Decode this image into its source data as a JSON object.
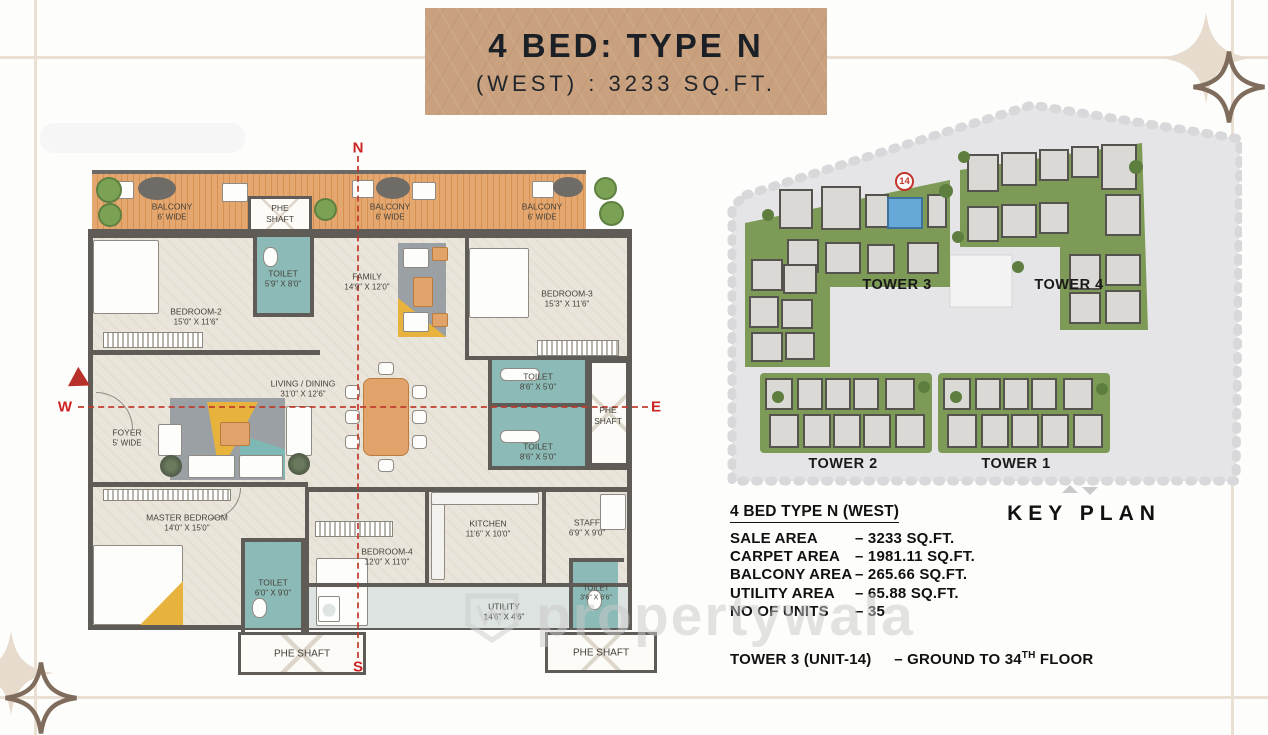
{
  "banner": {
    "title": "4 BED: TYPE N",
    "subtitle": "(WEST) : 3233 SQ.FT."
  },
  "compass": {
    "n": "N",
    "s": "S",
    "e": "E",
    "w": "W"
  },
  "plan": {
    "balconies": [
      {
        "name": "BALCONY",
        "dims": "6' WIDE"
      },
      {
        "name": "BALCONY",
        "dims": "6' WIDE"
      },
      {
        "name": "BALCONY",
        "dims": "6' WIDE"
      }
    ],
    "rooms": {
      "bedroom2": {
        "name": "BEDROOM-2",
        "dims": "15'0\" X 11'6\""
      },
      "bedroom3": {
        "name": "BEDROOM-3",
        "dims": "15'3\" X 11'6\""
      },
      "family": {
        "name": "FAMILY",
        "dims": "14'9\" X 12'0\""
      },
      "living": {
        "name": "LIVING / DINING",
        "dims": "31'0\" X 12'6\""
      },
      "foyer": {
        "name": "FOYER",
        "dims": "5' WIDE"
      },
      "master": {
        "name": "MASTER BEDROOM",
        "dims": "14'0\" X 15'0\""
      },
      "bedroom4": {
        "name": "BEDROOM-4",
        "dims": "12'0\" X 11'0\""
      },
      "kitchen": {
        "name": "KITCHEN",
        "dims": "11'6\" X 10'0\""
      },
      "staff": {
        "name": "STAFF",
        "dims": "6'9\" X 9'0\""
      },
      "utility": {
        "name": "UTILITY",
        "dims": "14'6\" X 4'6\""
      }
    },
    "toilets": [
      {
        "name": "TOILET",
        "dims": "5'9\" X 8'0\""
      },
      {
        "name": "TOILET",
        "dims": "8'6\" X 5'0\""
      },
      {
        "name": "TOILET",
        "dims": "8'6\" X 5'0\""
      },
      {
        "name": "TOILET",
        "dims": "6'0\" X 9'0\""
      },
      {
        "name": "TOILET",
        "dims": "3'6\" X 6'6\""
      }
    ],
    "phe": {
      "l1": "PHE",
      "l2": "SHAFT",
      "full": "PHE SHAFT"
    }
  },
  "key_plan": {
    "heading": "KEY PLAN",
    "unit_marker": "14",
    "tower3": "TOWER 3",
    "tower4": "TOWER 4",
    "tower2": "TOWER 2",
    "tower1": "TOWER 1"
  },
  "details": {
    "heading": "4 BED TYPE N (WEST)",
    "rows": [
      {
        "label": "SALE AREA",
        "value": "– 3233 SQ.FT."
      },
      {
        "label": "CARPET AREA",
        "value": "– 1981.11 SQ.FT."
      },
      {
        "label": "BALCONY AREA",
        "value": "– 265.66 SQ.FT."
      },
      {
        "label": "UTILITY AREA",
        "value": "– 65.88 SQ.FT."
      },
      {
        "label": "NO OF UNITS",
        "value": "– 35"
      }
    ],
    "tower_note": {
      "label": "TOWER 3 (UNIT-14)",
      "pre": "– GROUND TO 34",
      "sup": "TH",
      "post": " FLOOR"
    }
  },
  "watermark": "propertywala",
  "colors": {
    "banner_bg": "#c9a17f",
    "wall": "#5f5c58",
    "toilet_teal": "#8cbab6",
    "balcony_wood": "#e3a76f",
    "lawn_green": "#7d9b57",
    "highlight_unit_blue": "#66a9d8",
    "marker_red": "#c2342c",
    "compass_red": "#cc2222"
  }
}
